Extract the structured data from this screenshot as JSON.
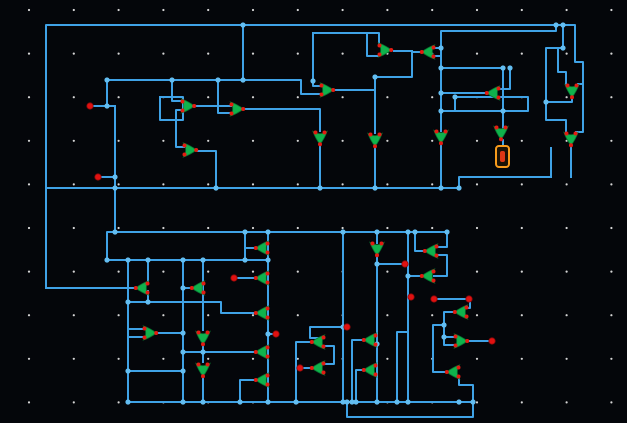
{
  "canvas": {
    "width": 627,
    "height": 423,
    "background": "#04060a"
  },
  "grid": {
    "origin_x": 29,
    "origin_y": 10,
    "step_x": 44.8,
    "step_y": 43.6,
    "cols": 14,
    "rows": 10,
    "dot_color": "#d6d6d6",
    "dot_radius": 1.1
  },
  "style": {
    "wire_color": "#3fa2e6",
    "wire_width": 2,
    "junction_color": "#63bdf1",
    "gate_color": "#10b24c",
    "gate_outline": "#077a31",
    "pin_color": "#e31b12",
    "terminal_color": "#e01111",
    "selection_color": "#f89b1c",
    "selection_glyph_color": "#dd3715"
  },
  "wires": [
    [
      [
        46,
        288
      ],
      [
        46,
        25
      ],
      [
        243,
        25
      ]
    ],
    [
      [
        243,
        25
      ],
      [
        556,
        25
      ]
    ],
    [
      [
        556,
        25
      ],
      [
        556,
        31
      ],
      [
        441,
        31
      ],
      [
        441,
        131
      ]
    ],
    [
      [
        441,
        48
      ],
      [
        435,
        48
      ]
    ],
    [
      [
        434,
        56
      ],
      [
        441,
        56
      ]
    ],
    [
      [
        420,
        52
      ],
      [
        412,
        52
      ],
      [
        412,
        77
      ],
      [
        375,
        77
      ]
    ],
    [
      [
        394,
        51
      ],
      [
        412,
        51
      ]
    ],
    [
      [
        313,
        33
      ],
      [
        379,
        33
      ],
      [
        379,
        46
      ]
    ],
    [
      [
        379,
        56
      ],
      [
        367,
        56
      ],
      [
        367,
        33
      ]
    ],
    [
      [
        313,
        33
      ],
      [
        313,
        81
      ]
    ],
    [
      [
        107,
        80
      ],
      [
        301,
        80
      ],
      [
        301,
        94
      ],
      [
        321,
        94
      ]
    ],
    [
      [
        321,
        86
      ],
      [
        313,
        86
      ],
      [
        313,
        81
      ]
    ],
    [
      [
        93,
        106
      ],
      [
        115,
        106
      ]
    ],
    [
      [
        107,
        80
      ],
      [
        107,
        106
      ]
    ],
    [
      [
        115,
        106
      ],
      [
        115,
        232
      ]
    ],
    [
      [
        101,
        177
      ],
      [
        115,
        177
      ]
    ],
    [
      [
        160,
        97
      ],
      [
        183,
        97
      ],
      [
        183,
        120
      ],
      [
        160,
        120
      ],
      [
        160,
        97
      ]
    ],
    [
      [
        172,
        80
      ],
      [
        172,
        101
      ],
      [
        182,
        101
      ]
    ],
    [
      [
        182,
        110
      ],
      [
        176,
        110
      ],
      [
        176,
        120
      ]
    ],
    [
      [
        176,
        120
      ],
      [
        176,
        147
      ],
      [
        184,
        147
      ]
    ],
    [
      [
        196,
        106
      ],
      [
        231,
        106
      ]
    ],
    [
      [
        231,
        113
      ],
      [
        218,
        113
      ],
      [
        218,
        80
      ]
    ],
    [
      [
        245,
        109
      ],
      [
        320,
        109
      ],
      [
        320,
        131
      ]
    ],
    [
      [
        198,
        151
      ],
      [
        216,
        151
      ],
      [
        216,
        188
      ]
    ],
    [
      [
        243,
        25
      ],
      [
        243,
        80
      ]
    ],
    [
      [
        335,
        90
      ],
      [
        375,
        90
      ]
    ],
    [
      [
        375,
        77
      ],
      [
        375,
        133
      ]
    ],
    [
      [
        375,
        147
      ],
      [
        375,
        188
      ]
    ],
    [
      [
        320,
        145
      ],
      [
        320,
        188
      ]
    ],
    [
      [
        441,
        68
      ],
      [
        503,
        68
      ],
      [
        503,
        128
      ]
    ],
    [
      [
        485,
        93
      ],
      [
        441,
        93
      ]
    ],
    [
      [
        441,
        111
      ],
      [
        528,
        111
      ],
      [
        528,
        97
      ],
      [
        455,
        97
      ],
      [
        455,
        111
      ]
    ],
    [
      [
        499,
        89
      ],
      [
        510,
        89
      ],
      [
        510,
        68
      ]
    ],
    [
      [
        563,
        25
      ],
      [
        563,
        48
      ],
      [
        546,
        48
      ],
      [
        546,
        102
      ],
      [
        572,
        102
      ],
      [
        572,
        98
      ]
    ],
    [
      [
        556,
        25
      ],
      [
        575,
        25
      ],
      [
        575,
        62
      ],
      [
        583,
        62
      ],
      [
        583,
        84
      ],
      [
        578,
        84
      ]
    ],
    [
      [
        566,
        84
      ],
      [
        566,
        72
      ],
      [
        558,
        72
      ],
      [
        558,
        48
      ],
      [
        563,
        48
      ]
    ],
    [
      [
        546,
        102
      ],
      [
        546,
        120
      ],
      [
        566,
        120
      ],
      [
        566,
        132
      ]
    ],
    [
      [
        576,
        132
      ],
      [
        583,
        132
      ],
      [
        583,
        84
      ]
    ],
    [
      [
        571,
        146
      ],
      [
        571,
        177
      ]
    ],
    [
      [
        46,
        188
      ],
      [
        459,
        188
      ],
      [
        459,
        177
      ],
      [
        551,
        177
      ]
    ],
    [
      [
        551,
        177
      ],
      [
        551,
        148
      ]
    ],
    [
      [
        441,
        143
      ],
      [
        441,
        188
      ]
    ],
    [
      [
        501,
        140
      ],
      [
        503,
        140
      ],
      [
        503,
        146
      ]
    ],
    [
      [
        447,
        232
      ],
      [
        107,
        232
      ],
      [
        107,
        260
      ],
      [
        268,
        260
      ]
    ],
    [
      [
        128,
        260
      ],
      [
        128,
        402
      ]
    ],
    [
      [
        148,
        260
      ],
      [
        148,
        283
      ]
    ],
    [
      [
        148,
        291
      ],
      [
        148,
        302
      ]
    ],
    [
      [
        134,
        288
      ],
      [
        46,
        288
      ]
    ],
    [
      [
        128,
        302
      ],
      [
        221,
        302
      ],
      [
        221,
        313
      ],
      [
        254,
        313
      ]
    ],
    [
      [
        183,
        260
      ],
      [
        183,
        402
      ]
    ],
    [
      [
        190,
        288
      ],
      [
        183,
        288
      ]
    ],
    [
      [
        158,
        333
      ],
      [
        183,
        333
      ]
    ],
    [
      [
        144,
        329
      ],
      [
        128,
        329
      ]
    ],
    [
      [
        144,
        337
      ],
      [
        128,
        337
      ]
    ],
    [
      [
        128,
        371
      ],
      [
        183,
        371
      ]
    ],
    [
      [
        203,
        260
      ],
      [
        203,
        330
      ]
    ],
    [
      [
        203,
        346
      ],
      [
        203,
        362
      ]
    ],
    [
      [
        203,
        378
      ],
      [
        203,
        402
      ]
    ],
    [
      [
        245,
        232
      ],
      [
        245,
        260
      ]
    ],
    [
      [
        254,
        248
      ],
      [
        245,
        248
      ]
    ],
    [
      [
        268,
        232
      ],
      [
        268,
        402
      ]
    ],
    [
      [
        254,
        278
      ],
      [
        238,
        278
      ]
    ],
    [
      [
        254,
        352
      ],
      [
        183,
        352
      ]
    ],
    [
      [
        254,
        380
      ],
      [
        240,
        380
      ],
      [
        240,
        402
      ]
    ],
    [
      [
        268,
        334
      ],
      [
        273,
        334
      ]
    ],
    [
      [
        310,
        368
      ],
      [
        303,
        368
      ]
    ],
    [
      [
        344,
        327
      ],
      [
        310,
        327
      ],
      [
        310,
        338
      ],
      [
        324,
        338
      ]
    ],
    [
      [
        343,
        232
      ],
      [
        343,
        402
      ]
    ],
    [
      [
        377,
        232
      ],
      [
        377,
        243
      ]
    ],
    [
      [
        377,
        257
      ],
      [
        377,
        402
      ]
    ],
    [
      [
        377,
        264
      ],
      [
        402,
        264
      ]
    ],
    [
      [
        324,
        346
      ],
      [
        334,
        346
      ],
      [
        334,
        364
      ],
      [
        324,
        364
      ]
    ],
    [
      [
        362,
        340
      ],
      [
        352,
        340
      ],
      [
        352,
        402
      ]
    ],
    [
      [
        362,
        370
      ],
      [
        356,
        370
      ],
      [
        356,
        402
      ]
    ],
    [
      [
        397,
        402
      ],
      [
        397,
        332
      ],
      [
        408,
        332
      ]
    ],
    [
      [
        408,
        232
      ],
      [
        408,
        402
      ]
    ],
    [
      [
        420,
        276
      ],
      [
        408,
        276
      ]
    ],
    [
      [
        423,
        251
      ],
      [
        415,
        251
      ],
      [
        415,
        232
      ]
    ],
    [
      [
        447,
        232
      ],
      [
        447,
        247
      ],
      [
        437,
        247
      ]
    ],
    [
      [
        437,
        255
      ],
      [
        447,
        255
      ],
      [
        447,
        276
      ],
      [
        434,
        276
      ]
    ],
    [
      [
        466,
        299
      ],
      [
        437,
        299
      ]
    ],
    [
      [
        467,
        308
      ],
      [
        470,
        308
      ],
      [
        470,
        301
      ]
    ],
    [
      [
        453,
        312
      ],
      [
        444,
        312
      ],
      [
        444,
        345
      ],
      [
        455,
        345
      ]
    ],
    [
      [
        455,
        337
      ],
      [
        444,
        337
      ]
    ],
    [
      [
        469,
        341
      ],
      [
        489,
        341
      ]
    ],
    [
      [
        444,
        325
      ],
      [
        433,
        325
      ],
      [
        433,
        372
      ],
      [
        445,
        372
      ]
    ],
    [
      [
        459,
        376
      ],
      [
        459,
        385
      ],
      [
        473,
        385
      ],
      [
        473,
        402
      ]
    ],
    [
      [
        128,
        402
      ],
      [
        473,
        402
      ]
    ],
    [
      [
        347,
        402
      ],
      [
        347,
        417
      ],
      [
        473,
        417
      ],
      [
        473,
        402
      ]
    ],
    [
      [
        310,
        342
      ],
      [
        296,
        342
      ],
      [
        296,
        402
      ]
    ]
  ],
  "junctions": [
    [
      243,
      25
    ],
    [
      556,
      25
    ],
    [
      563,
      25
    ],
    [
      243,
      80
    ],
    [
      172,
      80
    ],
    [
      107,
      80
    ],
    [
      218,
      80
    ],
    [
      313,
      81
    ],
    [
      375,
      77
    ],
    [
      441,
      68
    ],
    [
      503,
      68
    ],
    [
      510,
      68
    ],
    [
      441,
      93
    ],
    [
      441,
      111
    ],
    [
      455,
      97
    ],
    [
      503,
      111
    ],
    [
      441,
      48
    ],
    [
      107,
      106
    ],
    [
      115,
      177
    ],
    [
      115,
      188
    ],
    [
      216,
      188
    ],
    [
      320,
      188
    ],
    [
      375,
      188
    ],
    [
      441,
      188
    ],
    [
      459,
      188
    ],
    [
      546,
      102
    ],
    [
      563,
      48
    ],
    [
      115,
      232
    ],
    [
      245,
      232
    ],
    [
      268,
      232
    ],
    [
      343,
      232
    ],
    [
      377,
      232
    ],
    [
      408,
      232
    ],
    [
      415,
      232
    ],
    [
      447,
      232
    ],
    [
      107,
      260
    ],
    [
      128,
      260
    ],
    [
      148,
      260
    ],
    [
      183,
      260
    ],
    [
      203,
      260
    ],
    [
      245,
      260
    ],
    [
      268,
      260
    ],
    [
      128,
      302
    ],
    [
      148,
      302
    ],
    [
      183,
      288
    ],
    [
      183,
      333
    ],
    [
      183,
      352
    ],
    [
      203,
      352
    ],
    [
      128,
      371
    ],
    [
      183,
      371
    ],
    [
      343,
      327
    ],
    [
      268,
      334
    ],
    [
      377,
      264
    ],
    [
      377,
      344
    ],
    [
      408,
      276
    ],
    [
      444,
      337
    ],
    [
      444,
      325
    ],
    [
      128,
      402
    ],
    [
      183,
      402
    ],
    [
      203,
      402
    ],
    [
      240,
      402
    ],
    [
      268,
      402
    ],
    [
      296,
      402
    ],
    [
      343,
      402
    ],
    [
      347,
      402
    ],
    [
      352,
      402
    ],
    [
      356,
      402
    ],
    [
      377,
      402
    ],
    [
      397,
      402
    ],
    [
      408,
      402
    ],
    [
      459,
      402
    ],
    [
      473,
      402
    ]
  ],
  "gates": [
    {
      "x": 188,
      "y": 106,
      "dir": "right"
    },
    {
      "x": 237,
      "y": 109,
      "dir": "right"
    },
    {
      "x": 190,
      "y": 150,
      "dir": "right"
    },
    {
      "x": 327,
      "y": 90,
      "dir": "right"
    },
    {
      "x": 385,
      "y": 50,
      "dir": "right"
    },
    {
      "x": 428,
      "y": 52,
      "dir": "left"
    },
    {
      "x": 493,
      "y": 93,
      "dir": "left"
    },
    {
      "x": 572,
      "y": 91,
      "dir": "down"
    },
    {
      "x": 320,
      "y": 138,
      "dir": "down"
    },
    {
      "x": 375,
      "y": 140,
      "dir": "down"
    },
    {
      "x": 441,
      "y": 137,
      "dir": "down"
    },
    {
      "x": 501,
      "y": 133,
      "dir": "down"
    },
    {
      "x": 571,
      "y": 139,
      "dir": "down"
    },
    {
      "x": 150,
      "y": 333,
      "dir": "right"
    },
    {
      "x": 142,
      "y": 288,
      "dir": "left"
    },
    {
      "x": 198,
      "y": 288,
      "dir": "left"
    },
    {
      "x": 203,
      "y": 338,
      "dir": "down"
    },
    {
      "x": 203,
      "y": 370,
      "dir": "down"
    },
    {
      "x": 262,
      "y": 248,
      "dir": "left"
    },
    {
      "x": 262,
      "y": 278,
      "dir": "left"
    },
    {
      "x": 262,
      "y": 313,
      "dir": "left"
    },
    {
      "x": 262,
      "y": 352,
      "dir": "left"
    },
    {
      "x": 262,
      "y": 380,
      "dir": "left"
    },
    {
      "x": 318,
      "y": 342,
      "dir": "left"
    },
    {
      "x": 318,
      "y": 368,
      "dir": "left"
    },
    {
      "x": 370,
      "y": 340,
      "dir": "left"
    },
    {
      "x": 370,
      "y": 370,
      "dir": "left"
    },
    {
      "x": 377,
      "y": 249,
      "dir": "down"
    },
    {
      "x": 431,
      "y": 251,
      "dir": "left"
    },
    {
      "x": 428,
      "y": 276,
      "dir": "left"
    },
    {
      "x": 461,
      "y": 312,
      "dir": "left"
    },
    {
      "x": 461,
      "y": 341,
      "dir": "right"
    },
    {
      "x": 453,
      "y": 372,
      "dir": "left"
    }
  ],
  "terminals": [
    [
      90,
      106
    ],
    [
      98,
      177
    ],
    [
      234,
      278
    ],
    [
      276,
      334
    ],
    [
      300,
      368
    ],
    [
      347,
      327
    ],
    [
      411,
      297
    ],
    [
      405,
      264
    ],
    [
      492,
      341
    ],
    [
      469,
      299
    ],
    [
      434,
      299
    ]
  ],
  "selection": {
    "x": 496,
    "y": 146,
    "width": 13,
    "height": 21
  }
}
